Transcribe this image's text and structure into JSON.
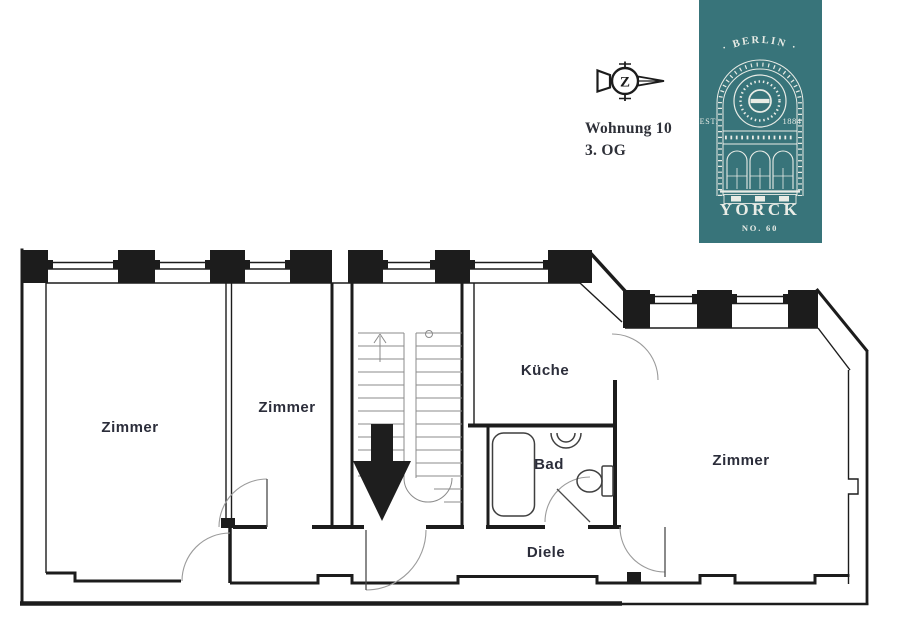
{
  "header": {
    "unit": "Wohnung 10",
    "floor": "3. OG"
  },
  "compass": {
    "letter": "Z"
  },
  "badge": {
    "city": "· BERLIN ·",
    "est": "EST.",
    "year": "1884",
    "name": "YORCK",
    "number": "NO. 60",
    "background": "#38747a",
    "foreground": "#e9ece6"
  },
  "floorplan": {
    "ink": "#1c1c1c",
    "label_color": "#2b2d3a",
    "rooms": [
      {
        "label": "Zimmer"
      },
      {
        "label": "Zimmer"
      },
      {
        "label": "Küche"
      },
      {
        "label": "Bad"
      },
      {
        "label": "Zimmer"
      },
      {
        "label": "Diele"
      }
    ]
  }
}
